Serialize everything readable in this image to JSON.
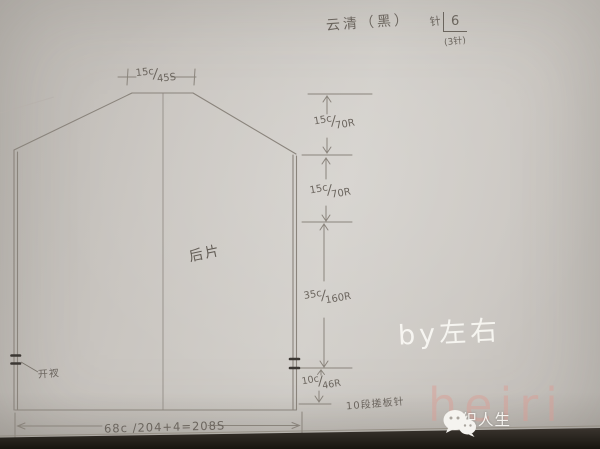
{
  "photo_notes": {
    "yarn": "云清（黑）",
    "needle": {
      "label": "针",
      "size": "6",
      "sub": "(3针)"
    }
  },
  "diagram": {
    "piece_label": "后片",
    "slit_label": "开衩",
    "garter_note": "10段搓板针",
    "measurements": {
      "neck_width": "15c/45S",
      "right_sections": [
        "15c/70R",
        "15c/70R",
        "35c/160R",
        "10c/46R"
      ],
      "bottom_width": "68c /204+4=208S"
    }
  },
  "watermarks": {
    "author": "by左右",
    "faint_text": "heiri",
    "logo_text": "编织人生",
    "logo_icon": "chat-bubbles-icon"
  },
  "colors": {
    "paper": "#cdc9c4",
    "pencil": "#8a847c",
    "ink": "#6b655e",
    "slit_mark": "#3b3733",
    "bottom_band": "#262320",
    "watermark_pink": "#dc9c93",
    "watermark_white": "#f5f3ef"
  }
}
